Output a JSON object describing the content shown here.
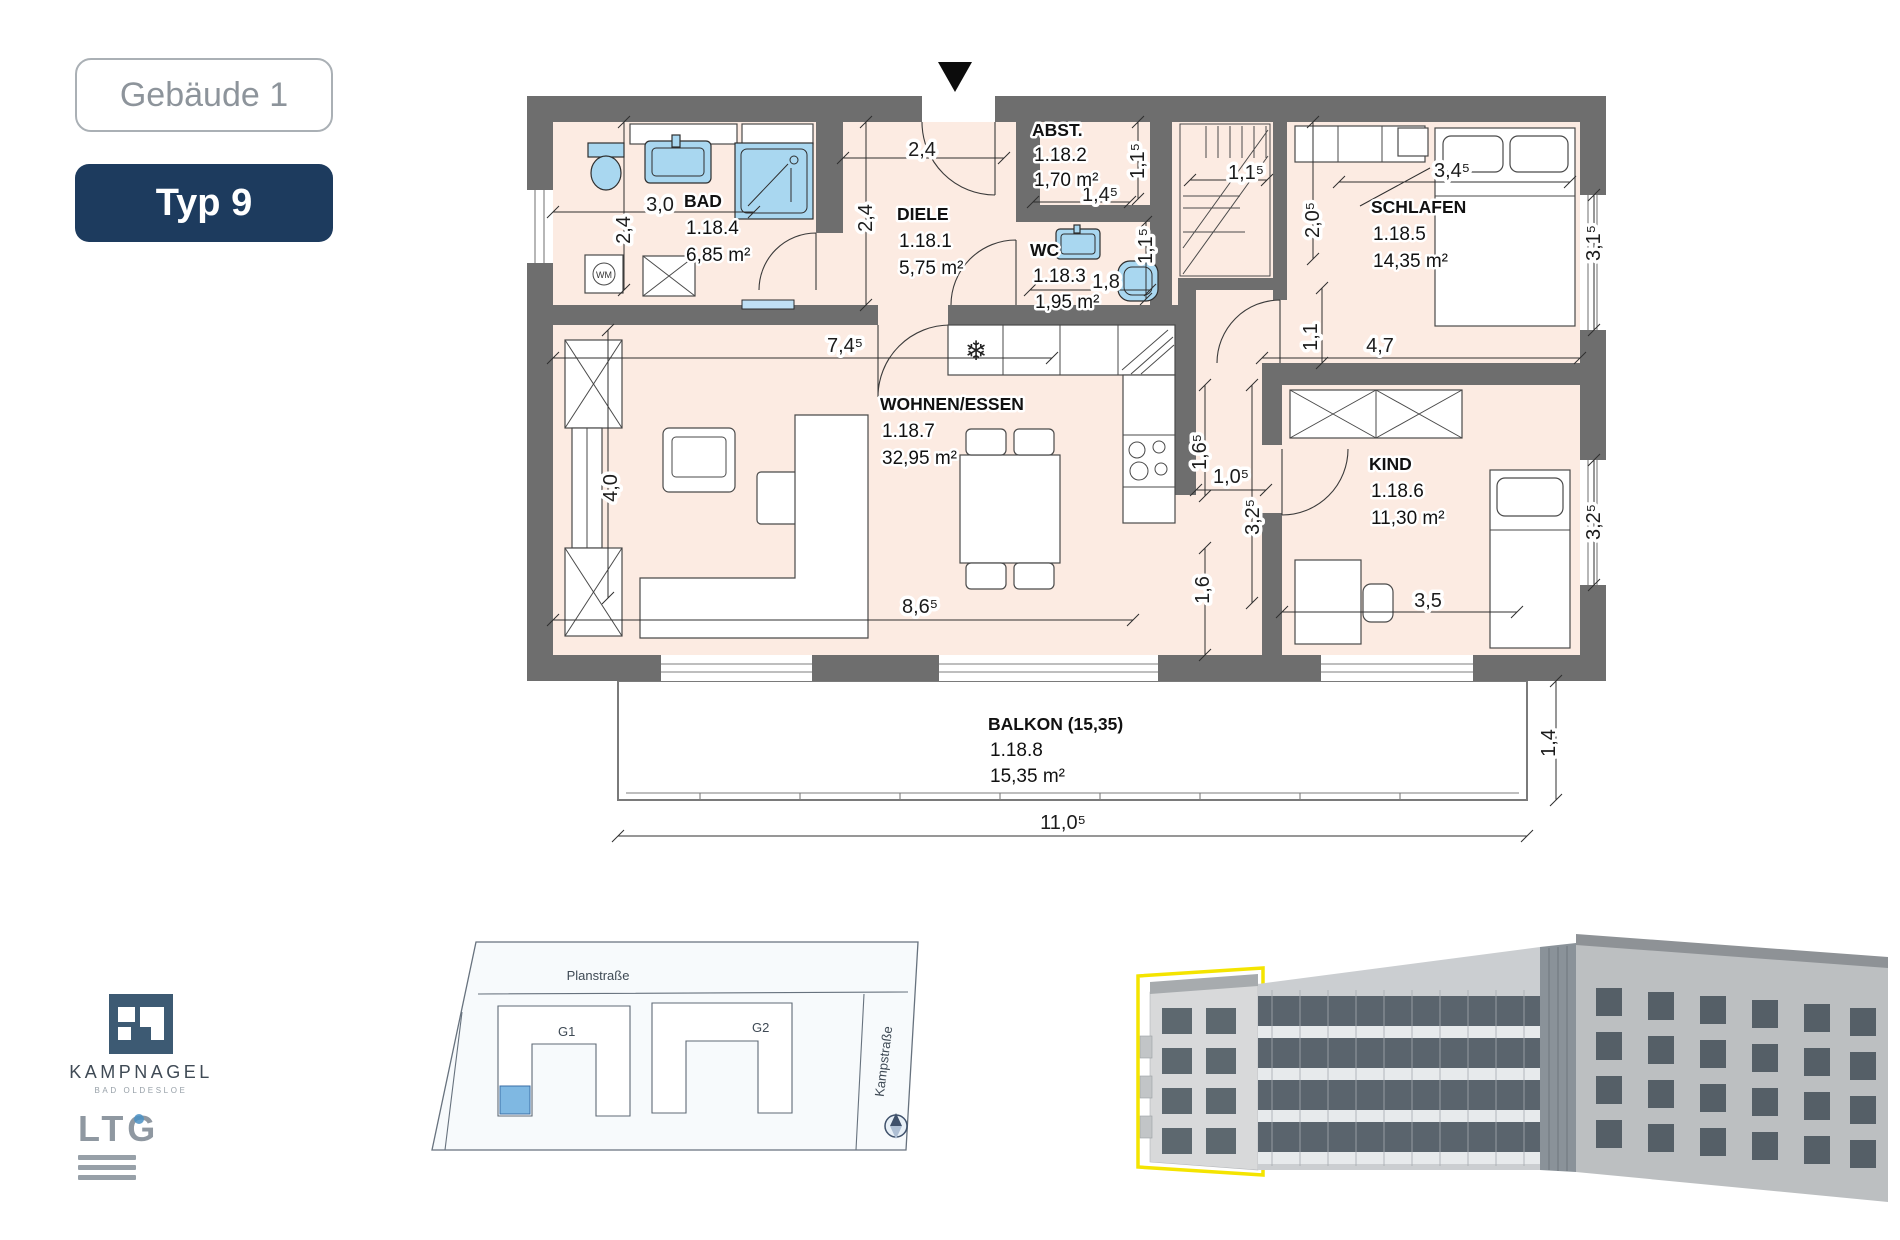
{
  "header": {
    "building": "Gebäude 1",
    "unit_type": "Typ 9"
  },
  "plan": {
    "rooms": [
      {
        "name": "BAD",
        "number": "1.18.4",
        "area": "6,85 m²"
      },
      {
        "name": "DIELE",
        "number": "1.18.1",
        "area": "5,75 m²"
      },
      {
        "name": "ABST.",
        "number": "1.18.2",
        "area": "1,70 m²"
      },
      {
        "name": "WC",
        "number": "1.18.3",
        "area": "1,95 m²"
      },
      {
        "name": "SCHLAFEN",
        "number": "1.18.5",
        "area": "14,35 m²"
      },
      {
        "name": "KIND",
        "number": "1.18.6",
        "area": "11,30 m²"
      },
      {
        "name": "WOHNEN/ESSEN",
        "number": "1.18.7",
        "area": "32,95 m²"
      },
      {
        "name": "BALKON (15,35)",
        "number": "1.18.8",
        "area": "15,35 m²"
      }
    ],
    "dimensions": [
      "3,0",
      "2,4",
      "2,4",
      "2,4",
      "1,4⁵",
      "1,1⁵",
      "1,8",
      "1,1⁵",
      "1,1⁵",
      "2,0⁵",
      "3,4⁵",
      "3,1⁵",
      "7,4⁵",
      "1,1",
      "4,7",
      "4,0",
      "1,6⁵",
      "1,0⁵",
      "3,2⁵",
      "1,6",
      "8,6⁵",
      "3,5",
      "3,2⁵",
      "11,0⁵",
      "1,4"
    ],
    "appliance_labels": {
      "washing_machine": "WM"
    },
    "icons": {
      "fridge": "❄"
    }
  },
  "site_plan": {
    "street_top": "Planstraße",
    "street_right": "Kampstraße",
    "building_left": "G1",
    "building_right": "G2"
  },
  "branding": {
    "company": "KAMPNAGEL",
    "location": "BAD OLDESLOE",
    "partner": "LTG"
  },
  "colors": {
    "navy": "#1d3b5e",
    "badge_border": "#aab0b5",
    "wall": "#6e6e6e",
    "room_fill": "#fcebe2",
    "fixture_blue": "#a9d7f0",
    "highlight_yellow": "#f4e400",
    "dim_text": "#1c1c1c"
  }
}
